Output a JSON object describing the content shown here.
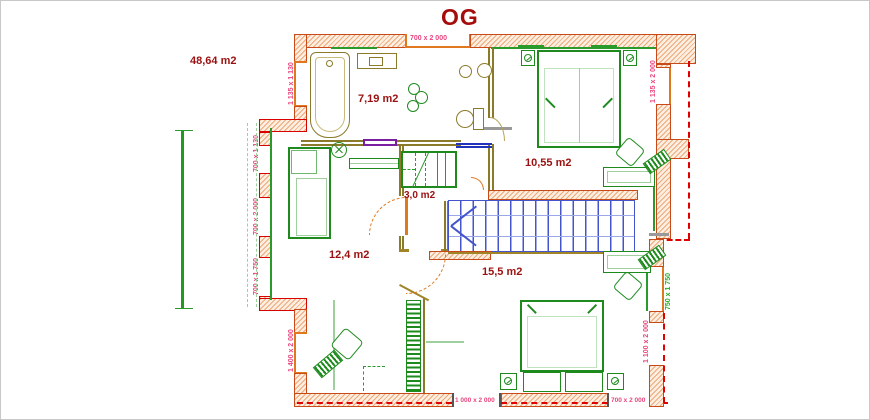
{
  "title": "OG",
  "plan": {
    "total_area_label": "48,64 m2",
    "room_labels": {
      "bathroom": "7,19 m2",
      "bedroom_top_right": "10,55 m2",
      "closet": "3,0 m2",
      "bedroom_left": "12,4 m2",
      "bedroom_bottom": "15,5 m2"
    },
    "window_dimensions": {
      "top": "700 x 2 000",
      "left_bathroom": "1 135 x 1 130",
      "left_dormer_upper": "700 x 1 130",
      "left_dormer_middle": "700 x 2 000",
      "left_dormer_lower": "700 x 1 750",
      "left_bottom": "1 400 x 2 000",
      "bottom_left": "1 000 x 2 000",
      "bottom_right": "700 x 2 000",
      "right_top": "1 135 x 2 000",
      "right_middle": "750 x 1 750",
      "right_bottom": "1 100 x 2 000"
    },
    "colors": {
      "title_text": "#a50d0d",
      "area_label_text": "#9b1111",
      "dimension_text": "#e8457e",
      "dimension_text_green": "#22aa22",
      "wall_hatch": "#e07a32",
      "roof_dashed_line": "#e00000",
      "furniture_green": "#1e8a1e",
      "furniture_light_green": "#9fcf9f",
      "sanitary_tan": "#8b7a2a",
      "stairs_blue": "#4455cc",
      "door_orange": "#e07820",
      "radiator_purple": "#7a1fa2"
    }
  }
}
